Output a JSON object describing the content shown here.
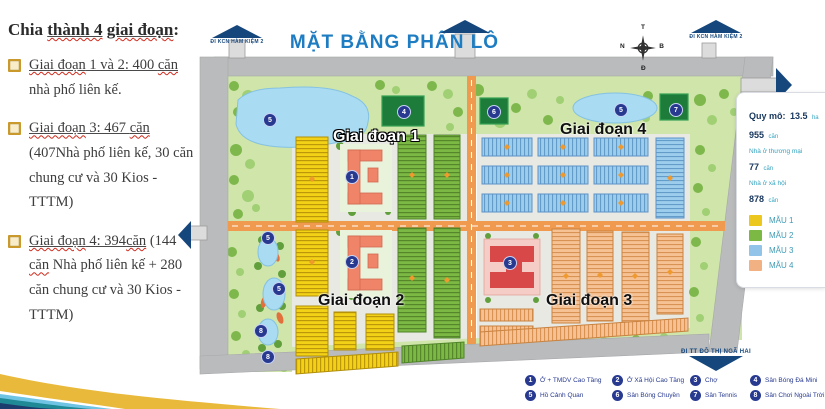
{
  "left_panel": {
    "title_segments": [
      {
        "t": "Chia "
      },
      {
        "t": "thành 4",
        "u": true,
        "w": true
      },
      {
        "t": " "
      },
      {
        "t": "giai đoạn",
        "u": true,
        "w": true
      },
      {
        "t": ":"
      }
    ],
    "bullets": [
      {
        "segments": [
          {
            "t": "Giai đoạn",
            "u": true,
            "w": true
          },
          {
            "t": " 1 và 2: 400 ",
            "u": true
          },
          {
            "t": "căn",
            "u": true,
            "w": true
          },
          {
            "t": " nhà phố liên kế."
          }
        ]
      },
      {
        "segments": [
          {
            "t": "Giai đoạn",
            "u": true,
            "w": true
          },
          {
            "t": " 3: 467 ",
            "u": true
          },
          {
            "t": "căn",
            "u": true,
            "w": true
          },
          {
            "t": " (407Nhà phố liên kế, 30 căn chung cư và 30 Kios - TTTM)"
          }
        ]
      },
      {
        "segments": [
          {
            "t": "Giai đoạn",
            "u": true,
            "w": true
          },
          {
            "t": " 4: 394",
            "u": true
          },
          {
            "t": "căn",
            "u": true,
            "w": true
          },
          {
            "t": " (144 "
          },
          {
            "t": "căn",
            "w": true
          },
          {
            "t": " Nhà phố liên kế + 280 căn chung cư và 30 Kios - TTTM)"
          }
        ]
      }
    ]
  },
  "map": {
    "title": "MẶT BẰNG PHÂN LÔ",
    "exits": {
      "top_left": "ĐI KCN HÀM KIỆM 2",
      "top_right": "ĐI KCN HÀM KIỆM 2",
      "bottom_right": "ĐI TT ĐÔ THỊ NGÃ HAI"
    },
    "compass": {
      "top": "T",
      "left": "N",
      "right": "B",
      "bottom": "Đ"
    },
    "phase_labels": [
      {
        "label": "Giai đoạn 1"
      },
      {
        "label": "Giai đoạn 2"
      },
      {
        "label": "Giai đoạn 3"
      },
      {
        "label": "Giai đoạn 4"
      }
    ],
    "markers": [
      {
        "n": "1",
        "x": 352,
        "y": 177
      },
      {
        "n": "2",
        "x": 352,
        "y": 262
      },
      {
        "n": "3",
        "x": 510,
        "y": 263
      },
      {
        "n": "4",
        "x": 404,
        "y": 112
      },
      {
        "n": "5",
        "x": 270,
        "y": 120
      },
      {
        "n": "5",
        "x": 621,
        "y": 110
      },
      {
        "n": "5",
        "x": 268,
        "y": 238
      },
      {
        "n": "5",
        "x": 279,
        "y": 289
      },
      {
        "n": "6",
        "x": 494,
        "y": 112
      },
      {
        "n": "7",
        "x": 676,
        "y": 110
      },
      {
        "n": "8",
        "x": 261,
        "y": 331
      },
      {
        "n": "8",
        "x": 268,
        "y": 357
      }
    ]
  },
  "info_panel": {
    "area_label": "Quy mô:",
    "area_value": "13.5",
    "area_unit": "ha",
    "total_value": "955",
    "total_unit": "căn",
    "rows": [
      {
        "label": "Nhà ở thương mại",
        "value": "77",
        "unit": "căn"
      },
      {
        "label": "Nhà ở xã hội",
        "value": "878",
        "unit": "căn"
      }
    ],
    "samples": [
      {
        "label": "MẪU 1",
        "color": "#ecc71d"
      },
      {
        "label": "MẪU 2",
        "color": "#7cb944"
      },
      {
        "label": "MẪU 3",
        "color": "#92c4e9"
      },
      {
        "label": "MẪU 4",
        "color": "#f2b183"
      }
    ]
  },
  "legend": {
    "items": [
      {
        "n": "1",
        "label": "Ở + TMDV Cao Tầng"
      },
      {
        "n": "2",
        "label": "Ở Xã Hội Cao Tầng"
      },
      {
        "n": "3",
        "label": "Chợ"
      },
      {
        "n": "4",
        "label": "Sân Bóng Đá Mini"
      },
      {
        "n": "5",
        "label": "Hồ Cảnh Quan"
      },
      {
        "n": "6",
        "label": "Sân Bóng Chuyền"
      },
      {
        "n": "7",
        "label": "Sân Tennis"
      },
      {
        "n": "8",
        "label": "Sân Chơi Ngoài Trời"
      }
    ]
  }
}
